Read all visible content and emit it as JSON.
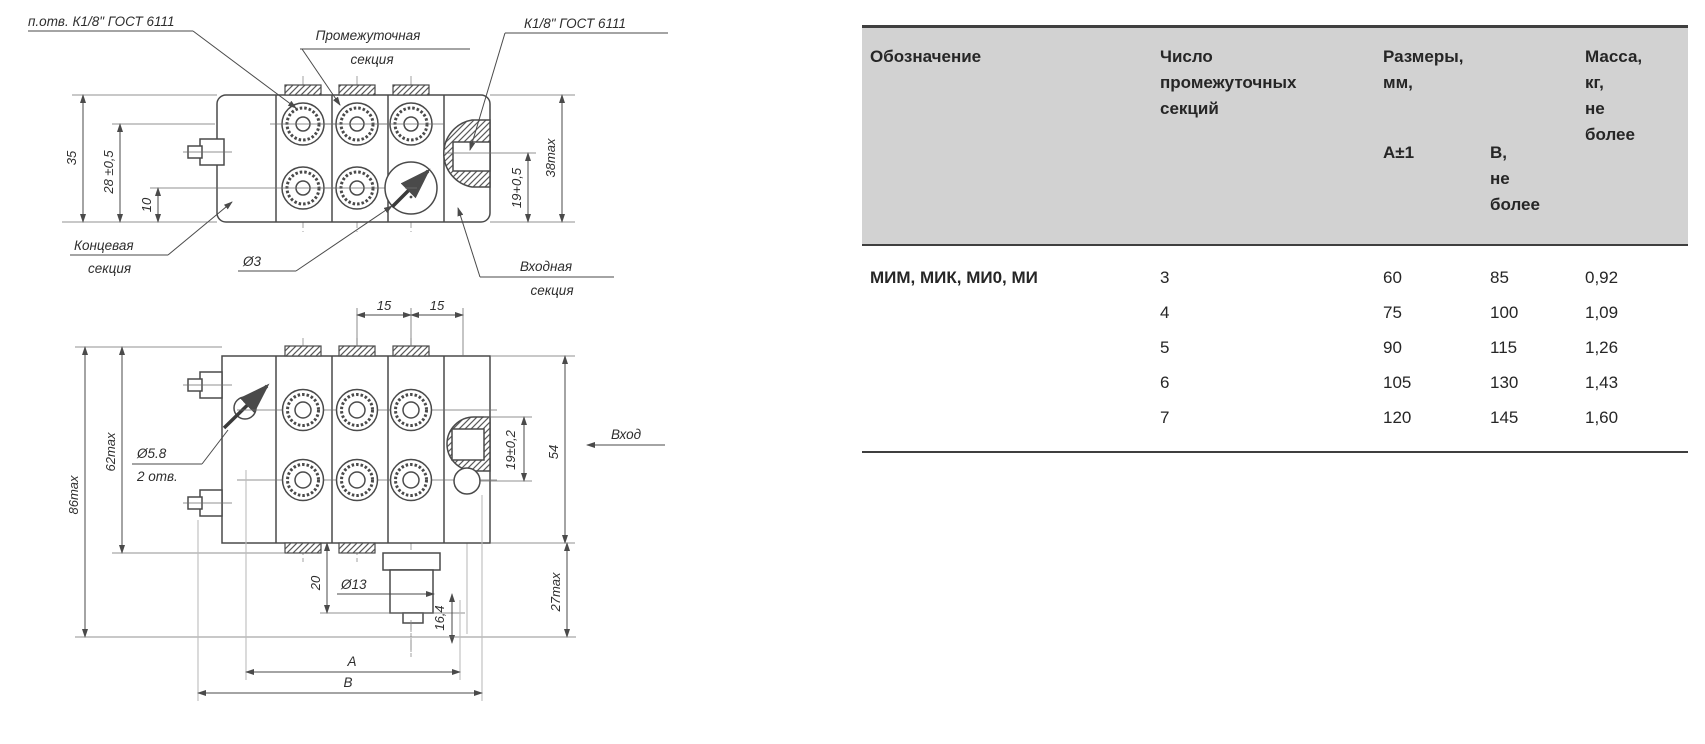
{
  "drawings": {
    "top": {
      "callout_ports": "п.отв. К1/8\" ГОСТ 6111",
      "callout_intermediate_1": "Промежуточная",
      "callout_intermediate_2": "секция",
      "callout_inlet_thread": "К1/8\" ГОСТ 6111",
      "callout_end_1": "Концевая",
      "callout_end_2": "секция",
      "callout_inlet_1": "Входная",
      "callout_inlet_2": "секция",
      "dim_35": "35",
      "dim_28": "28 ±0,5",
      "dim_10": "10",
      "dim_19": "19+0,5",
      "dim_38": "38max",
      "dim_d3": "Ø3"
    },
    "front": {
      "dim_15a": "15",
      "dim_15b": "15",
      "dim_54": "54",
      "dim_19": "19±0,2",
      "dim_86": "86max",
      "dim_62": "62max",
      "dim_27": "27max",
      "dim_20": "20",
      "dim_d13": "Ø13",
      "dim_64": "16,4",
      "dim_A": "A",
      "dim_B": "B",
      "callout_hole_1": "Ø5.8",
      "callout_hole_2": "2 отв.",
      "label_inlet": "Вход"
    }
  },
  "table": {
    "col_designation": "Обозначение",
    "col_sections": "Число\nпромежуточных\nсекций",
    "col_dims": "Размеры,\nмм,",
    "col_a": "А±1",
    "col_b": "В,\nне\nболее",
    "col_mass": "Масса,\nкг,\nне\nболее",
    "designation": "МИМ, МИК, МИ0, МИ",
    "rows": [
      {
        "n": "3",
        "a": "60",
        "b": "85",
        "m": "0,92"
      },
      {
        "n": "4",
        "a": "75",
        "b": "100",
        "m": "1,09"
      },
      {
        "n": "5",
        "a": "90",
        "b": "115",
        "m": "1,26"
      },
      {
        "n": "6",
        "a": "105",
        "b": "130",
        "m": "1,43"
      },
      {
        "n": "7",
        "a": "120",
        "b": "145",
        "m": "1,60"
      }
    ]
  },
  "colors": {
    "header_bg": "#d2d2d2",
    "rule": "#3f3f3f",
    "line": "#4a4a4a"
  }
}
